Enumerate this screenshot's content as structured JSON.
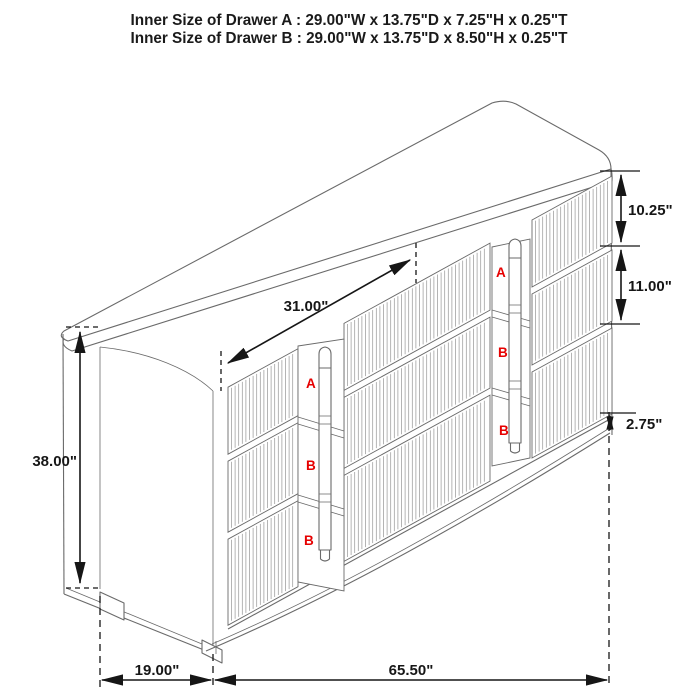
{
  "title": {
    "line1": "Inner Size of Drawer A : 29.00\"W x 13.75\"D x 7.25\"H x 0.25\"T",
    "line2": "Inner Size of Drawer B : 29.00\"W x 13.75\"D x 8.50\"H x 0.25\"T"
  },
  "dimensions": {
    "top_section_width": "31.00\"",
    "overall_height": "38.00\"",
    "drawer_a_front_height": "10.25\"",
    "drawer_b_front_height": "11.00\"",
    "base_height": "2.75\"",
    "overall_depth": "19.00\"",
    "overall_width": "65.50\""
  },
  "drawer_labels": {
    "left_column": [
      "A",
      "B",
      "B"
    ],
    "right_column": [
      "A",
      "B",
      "B"
    ]
  },
  "colors": {
    "dimension_lines": "#161616",
    "cabinet_lines": "#6a6a6a",
    "flute_lines": "#9b9b9b",
    "drawer_label_red": "#e60000",
    "background": "#ffffff"
  }
}
